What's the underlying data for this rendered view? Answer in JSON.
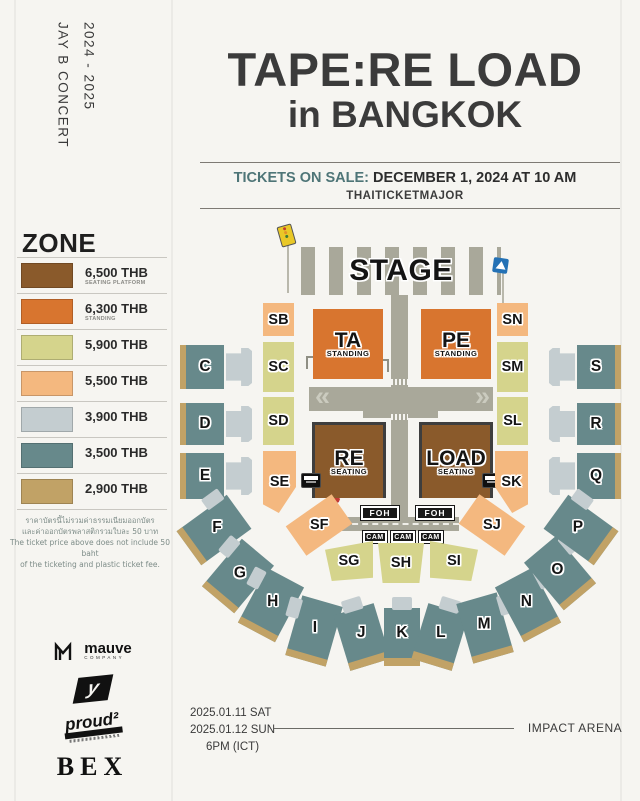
{
  "poster": {
    "side": {
      "years": "2024 - 2025",
      "artist": "JAY B CONCERT"
    },
    "title": {
      "line1": "TAPE:RE LOAD",
      "line2": "in BANGKOK"
    },
    "sale": {
      "label": "TICKETS ON SALE:",
      "value": "DECEMBER 1, 2024 AT 10 AM",
      "vendor": "THAITICKETMAJOR"
    },
    "legend": {
      "heading": "ZONE",
      "items": [
        {
          "price": "6,500 THB",
          "note": "SEATING PLATFORM",
          "color": "#8a5a2b"
        },
        {
          "price": "6,300 THB",
          "note": "STANDING",
          "color": "#d8752f"
        },
        {
          "price": "5,900 THB",
          "note": "",
          "color": "#d5d48c"
        },
        {
          "price": "5,500 THB",
          "note": "",
          "color": "#f4b87f"
        },
        {
          "price": "3,900 THB",
          "note": "",
          "color": "#c4cdd0"
        },
        {
          "price": "3,500 THB",
          "note": "",
          "color": "#67898b"
        },
        {
          "price": "2,900 THB",
          "note": "",
          "color": "#c1a266"
        }
      ],
      "disclaimer": [
        "ราคาบัตรนี้ไม่รวมค่าธรรมเนียมออกบัตร",
        "และค่าออกบัตรพลาสติกรวมใบละ 50 บาท",
        "The ticket price above does not include 50 baht",
        "of the ticketing and plastic ticket fee."
      ]
    },
    "map": {
      "stage": "STAGE",
      "ta": {
        "label": "TA",
        "sub": "STANDING"
      },
      "pe": {
        "label": "PE",
        "sub": "STANDING"
      },
      "re": {
        "label": "RE",
        "sub": "SEATING"
      },
      "load": {
        "label": "LOAD",
        "sub": "SEATING"
      },
      "sb": "SB",
      "sc": "SC",
      "sd": "SD",
      "se": "SE",
      "sf": "SF",
      "sg": "SG",
      "sh": "SH",
      "si": "SI",
      "sj": "SJ",
      "sk": "SK",
      "sl": "SL",
      "sm": "SM",
      "sn": "SN",
      "c": "C",
      "d": "D",
      "e": "E",
      "f": "F",
      "g": "G",
      "h": "H",
      "i": "I",
      "j": "J",
      "k": "K",
      "l": "L",
      "m": "M",
      "n": "N",
      "o": "O",
      "p": "P",
      "q": "Q",
      "r": "R",
      "s": "S",
      "foh": "FOH",
      "cam": "CAM",
      "arrow_left": "«",
      "arrow_right": "»",
      "icons": [
        "traffic-light-sign",
        "pedestrian-crossing-sign",
        "stop-sign",
        "platform-marker",
        "street-lamp"
      ]
    },
    "footer": {
      "date1": "2025.01.11 SAT",
      "date2": "2025.01.12 SUN",
      "time": "6PM (ICT)",
      "venue": "IMPACT ARENA"
    },
    "logos": {
      "mauve": "mauve",
      "mauve_sub": "COMPANY",
      "proud": "proud²",
      "bex": "BEX"
    }
  }
}
